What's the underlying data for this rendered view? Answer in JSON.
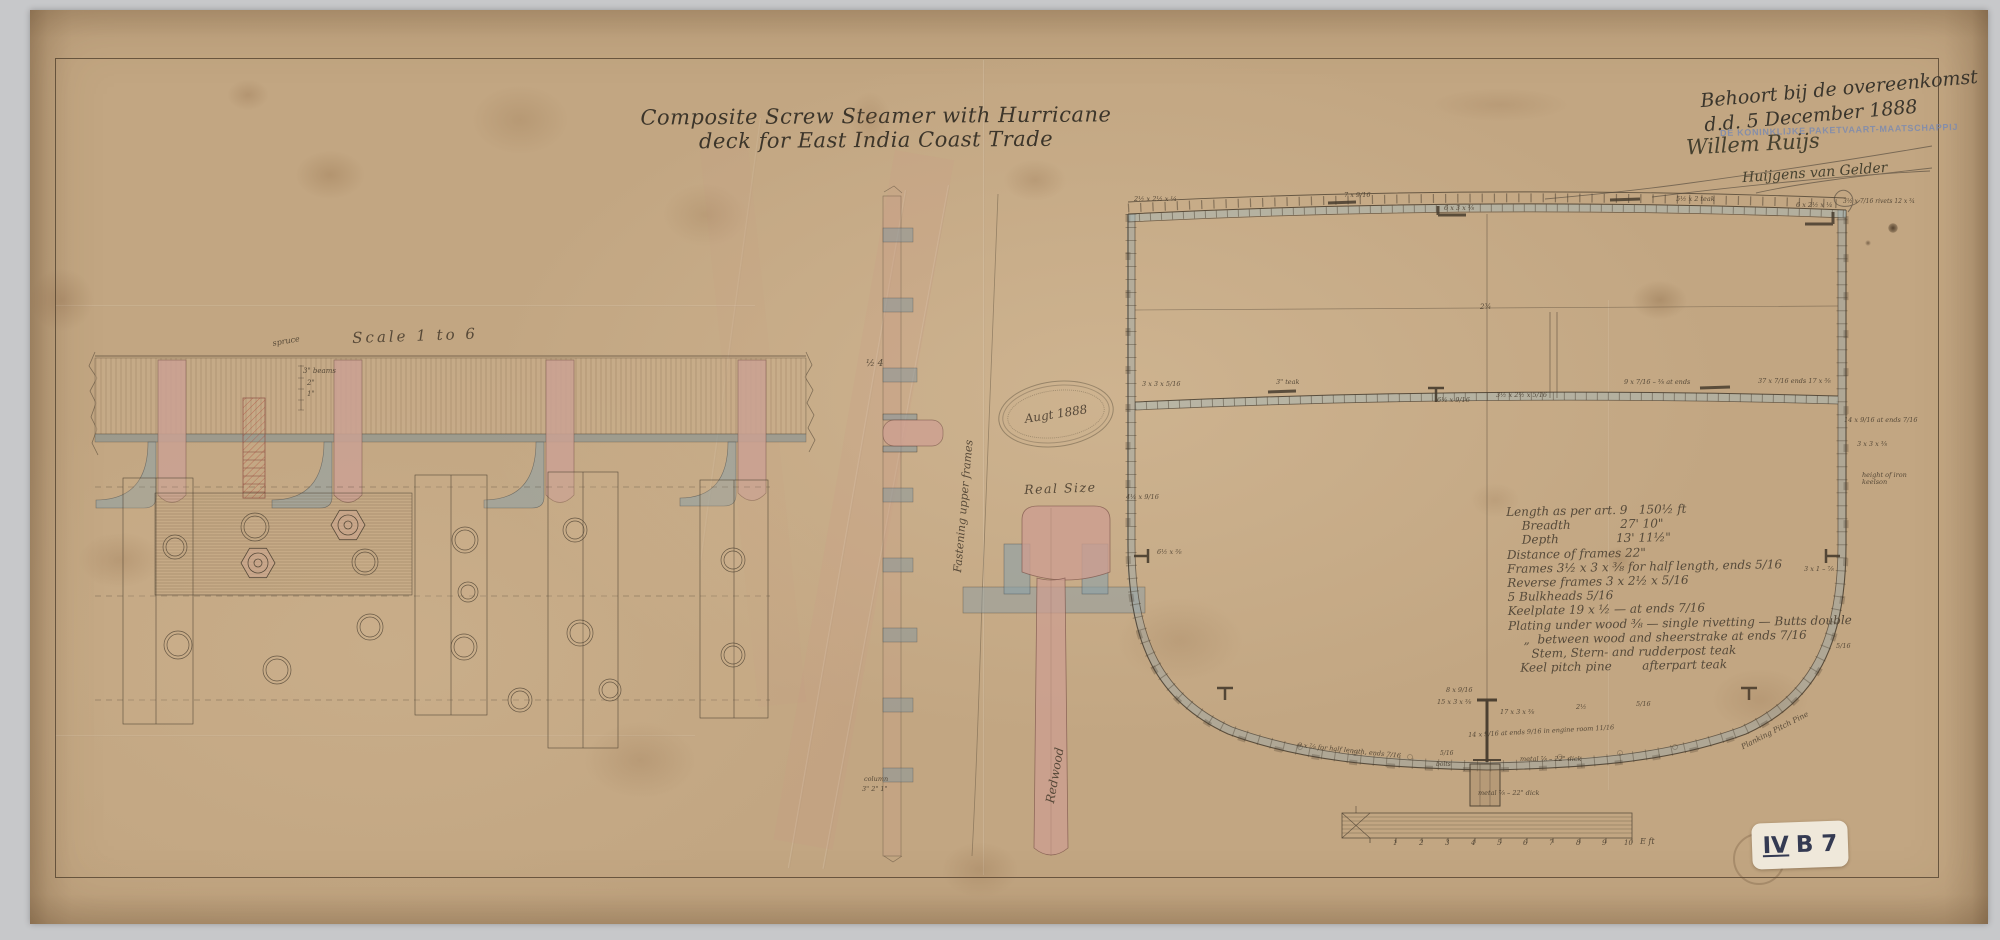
{
  "sheet": {
    "title": "Composite Screw Steamer with Hurricane deck for East India Coast Trade",
    "archive_label": {
      "roman": "IV",
      "rest": "B 7"
    }
  },
  "contract_note": {
    "line1": "Behoort bij de overeenkomst",
    "line2": "d.d. 5 December 1888",
    "company_stamp": "DE KONINKLIJKE PAKETVAART-MAATSCHAPPIJ",
    "signature1": "Willem Ruijs",
    "signature2": "Huijgens van Gelder"
  },
  "date_stamp": {
    "text": "Augt 1888"
  },
  "specifications": {
    "lines": [
      {
        "t": "Length as per art. 9   150½ ft"
      },
      {
        "t": "    Breadth             27' 10\""
      },
      {
        "t": "    Depth               13' 11½\""
      },
      {
        "t": "Distance of frames 22\""
      },
      {
        "t": "Frames 3½ x 3 x ⅜ for half length, ends 5/16"
      },
      {
        "t": "Reverse frames 3 x 2½ x 5/16"
      },
      {
        "t": "5 Bulkheads 5/16"
      },
      {
        "t": "Keelplate 19 x ½ — at ends 7/16"
      },
      {
        "t": "Plating under wood ⅜ — single rivetting — Butts double"
      },
      {
        "t": "    „  between wood and sheerstrake at ends 7/16"
      },
      {
        "t": "      Stem, Stern- and rudderpost teak"
      },
      {
        "t": "   Keel pitch pine        afterpart teak"
      }
    ]
  },
  "annotations": [
    {
      "t": "spruce",
      "x": 272,
      "y": 340,
      "fs": 8,
      "r": -10
    },
    {
      "t": "Scale 1 to 6",
      "x": 352,
      "y": 331,
      "fs": 15,
      "r": -2,
      "cls": "ls2"
    },
    {
      "t": "3\" beams",
      "x": 303,
      "y": 368,
      "fs": 7
    },
    {
      "t": "2\"",
      "x": 307,
      "y": 380,
      "fs": 7
    },
    {
      "t": "1\"",
      "x": 307,
      "y": 391,
      "fs": 7
    },
    {
      "t": "½ 4",
      "x": 866,
      "y": 360,
      "fs": 9
    },
    {
      "t": "Fastening upper frames",
      "x": 952,
      "y": 572,
      "fs": 11,
      "r": -85
    },
    {
      "t": "column",
      "x": 864,
      "y": 776,
      "fs": 6.5
    },
    {
      "t": "3\"  2\"  1\"",
      "x": 862,
      "y": 786,
      "fs": 6.5
    },
    {
      "t": "Real Size",
      "x": 1024,
      "y": 483,
      "fs": 12.5,
      "r": -2,
      "cls": "ls1"
    },
    {
      "t": "Redwood",
      "x": 1044,
      "y": 802,
      "fs": 12,
      "r": -80
    },
    {
      "t": "2½ x 2½ x ¼",
      "x": 1134,
      "y": 196,
      "fs": 6.5
    },
    {
      "t": "7 x 9/16",
      "x": 1344,
      "y": 192,
      "fs": 6.5
    },
    {
      "t": "6 x 3 x ⅜",
      "x": 1444,
      "y": 205,
      "fs": 6.5
    },
    {
      "t": "5½ x 2 teak",
      "x": 1676,
      "y": 196,
      "fs": 6.5
    },
    {
      "t": "6 x 2½ x ¼",
      "x": 1796,
      "y": 202,
      "fs": 6.5
    },
    {
      "t": "3½ x 7/16 rivets 12 x ¾",
      "x": 1843,
      "y": 199,
      "fs": 6
    },
    {
      "t": "2¾",
      "x": 1480,
      "y": 304,
      "fs": 7
    },
    {
      "t": "3 x 3 x 5/16",
      "x": 1142,
      "y": 381,
      "fs": 6.5
    },
    {
      "t": "3\" teak",
      "x": 1276,
      "y": 379,
      "fs": 6.5
    },
    {
      "t": "6¼ x 9/16",
      "x": 1437,
      "y": 397,
      "fs": 6.5
    },
    {
      "t": "3½ x 2½ x 5/16",
      "x": 1496,
      "y": 392,
      "fs": 6.5
    },
    {
      "t": "9 x 7/16 – ⅜ at ends",
      "x": 1624,
      "y": 379,
      "fs": 6.5
    },
    {
      "t": "37 x 7/16 ends 17 x ⅜",
      "x": 1758,
      "y": 378,
      "fs": 6.5
    },
    {
      "t": "14 x 9/16 at ends 7/16",
      "x": 1844,
      "y": 417,
      "fs": 6.5
    },
    {
      "t": "3 x 3 x ⅜",
      "x": 1857,
      "y": 441,
      "fs": 6.5
    },
    {
      "t": "height of iron keelson",
      "x": 1862,
      "y": 472,
      "fs": 6.5,
      "w": 55,
      "cls": "wrap"
    },
    {
      "t": "3 x 1 – ⅞",
      "x": 1804,
      "y": 566,
      "fs": 6.5
    },
    {
      "t": "5/16",
      "x": 1836,
      "y": 643,
      "fs": 6.5
    },
    {
      "t": "4¼ x 9/16",
      "x": 1126,
      "y": 494,
      "fs": 6.5
    },
    {
      "t": "6½ x ⅜",
      "x": 1157,
      "y": 549,
      "fs": 6.5
    },
    {
      "t": "8 x 9/16",
      "x": 1446,
      "y": 687,
      "fs": 6.5
    },
    {
      "t": "15 x 3 x ⅜",
      "x": 1437,
      "y": 699,
      "fs": 6.5
    },
    {
      "t": "17 x 3 x ⅜",
      "x": 1500,
      "y": 709,
      "fs": 6.5
    },
    {
      "t": "2½",
      "x": 1576,
      "y": 704,
      "fs": 6.5
    },
    {
      "t": "5/16",
      "x": 1636,
      "y": 701,
      "fs": 6.5
    },
    {
      "t": "14 x 9/16 at ends 9/16 in engine room 11/16",
      "x": 1468,
      "y": 732,
      "fs": 6.5,
      "r": -3
    },
    {
      "t": "Planking Pitch Pine",
      "x": 1740,
      "y": 744,
      "fs": 7.5,
      "r": -27
    },
    {
      "t": "9 x ⅞ for half length, ends 7/16",
      "x": 1298,
      "y": 742,
      "fs": 6.5,
      "r": 6
    },
    {
      "t": "metal ⅞ – 22\" dick",
      "x": 1520,
      "y": 756,
      "fs": 6.5
    },
    {
      "t": "metal ⅞ – 22\" dick",
      "x": 1478,
      "y": 790,
      "fs": 6.5
    },
    {
      "t": "5/16",
      "x": 1440,
      "y": 751,
      "fs": 6
    },
    {
      "t": "bolts",
      "x": 1436,
      "y": 762,
      "fs": 6
    },
    {
      "t": "1",
      "x": 1393,
      "y": 840,
      "fs": 7
    },
    {
      "t": "2",
      "x": 1419,
      "y": 840,
      "fs": 7
    },
    {
      "t": "3",
      "x": 1445,
      "y": 840,
      "fs": 7
    },
    {
      "t": "4",
      "x": 1471,
      "y": 840,
      "fs": 7
    },
    {
      "t": "5",
      "x": 1497,
      "y": 840,
      "fs": 7
    },
    {
      "t": "6",
      "x": 1523,
      "y": 840,
      "fs": 7
    },
    {
      "t": "7",
      "x": 1549,
      "y": 840,
      "fs": 7
    },
    {
      "t": "8",
      "x": 1576,
      "y": 840,
      "fs": 7
    },
    {
      "t": "9",
      "x": 1602,
      "y": 840,
      "fs": 7
    },
    {
      "t": "10",
      "x": 1624,
      "y": 840,
      "fs": 7
    },
    {
      "t": "E ft",
      "x": 1640,
      "y": 838,
      "fs": 8
    }
  ],
  "colors": {
    "paper": "#c2a682",
    "ink": "#473c2e",
    "wash_blue": "#96aab0",
    "wash_pink": "#c99f92",
    "stamp_blue": "#7a8ab0"
  }
}
